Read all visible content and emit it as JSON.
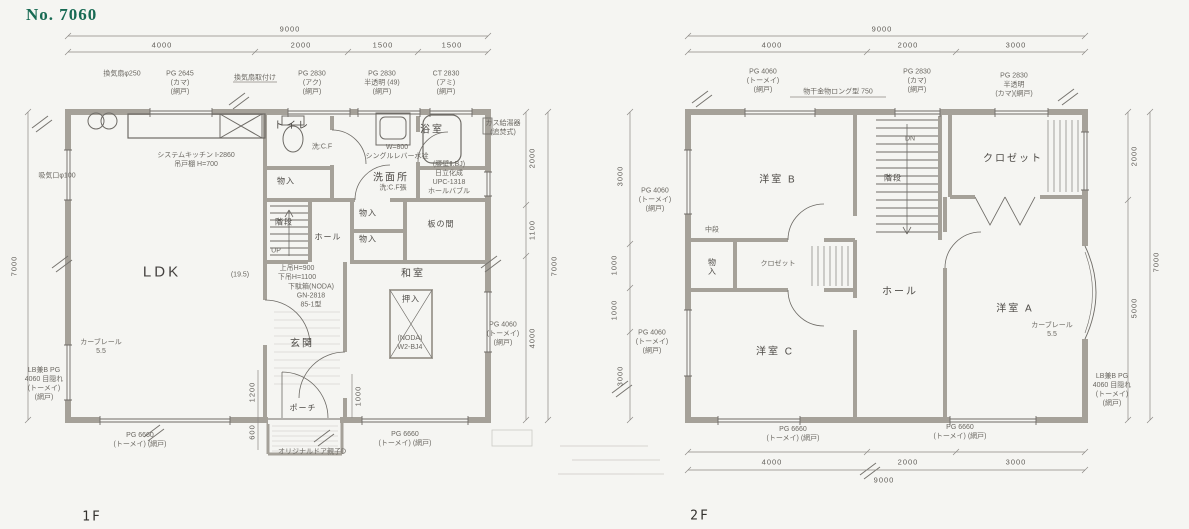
{
  "title": "No. 7060",
  "f1": {
    "floor_label": "1F",
    "rooms": {
      "ldk": "LDK",
      "ldk_size": "(19.5)",
      "toilet": "トイレ",
      "bath": "浴室",
      "washroom": "洗面所",
      "storage_a": "物入",
      "storage_b": "物入",
      "storage_c": "物入",
      "stairs": "階段",
      "up": "UP",
      "hall": "ホール",
      "itanoma": "板の間",
      "washitsu": "和室",
      "oshiire": "押入",
      "genkan": "玄関",
      "porch": "ポーチ"
    },
    "ann": {
      "kitchen1": "システムキッチン I-2860",
      "kitchen2": "吊戸棚 H=700",
      "vent_fan": "換気扇φ250",
      "pg2645_1": "PG 2645",
      "pg2645_2": "(カマ)",
      "pg2645_3": "(網戸)",
      "vent_note": "換気扇取付け",
      "pg2830a_1": "PG 2830",
      "pg2830a_2": "(アク)",
      "pg2830a_3": "(網戸)",
      "pg2830b_1": "PG 2830",
      "pg2830b_2": "半透明 (49)",
      "pg2830b_3": "(網戸)",
      "ct2830_1": "CT 2830",
      "ct2830_2": "(アミ)",
      "ct2830_3": "(網戸)",
      "basin1": "W=800",
      "basin2": "シングルレバー水栓",
      "toilet_floor": "洗:C.F",
      "wash_floor": "洗:C.F張",
      "bath1": "(腰壁Ⅱ.BJ)",
      "bath2": "日立化成",
      "bath3": "UPC-1318",
      "bath4": "ホールバブル",
      "heater1": "ガス給湯器",
      "heater2": "(追焚式)",
      "lintel1": "上吊H=900",
      "lintel2": "下吊H=1100",
      "geta1": "下駄箱(NODA)",
      "geta2": "GN-2818",
      "geta3": "85-1型",
      "oshi1": "(NODA)",
      "oshi2": "W2-BJ4",
      "door": "オリジナルドア親子D",
      "curtain1": "カーブレール",
      "curtain2": "5.5",
      "intake": "吸気口φ100",
      "lb1": "LB兼B PG",
      "lb2": "4060 目隠れ",
      "lb3": "(トーメイ)",
      "lb4": "(網戸)",
      "pg4060r_1": "PG 4060",
      "pg4060r_2": "(トーメイ)",
      "pg4060r_3": "(網戸)",
      "pg6660a_1": "PG 6660",
      "pg6660a_2": "(トーメイ) (網戸)",
      "pg6660b_1": "PG 6660",
      "pg6660b_2": "(トーメイ) (網戸)"
    },
    "dims": {
      "w_total": "9000",
      "w1": "4000",
      "w2": "2000",
      "w3": "1500",
      "w4": "1500",
      "h_total": "7000",
      "r1": "2000",
      "r2": "1100",
      "r3": "4000",
      "r_total": "7000",
      "porch1": "1200",
      "porch2": "600",
      "porch3": "1000"
    }
  },
  "f2": {
    "floor_label": "2F",
    "rooms": {
      "b": "洋室 B",
      "a": "洋室 A",
      "c": "洋室 C",
      "closet": "クロゼット",
      "closet2": "クロゼット",
      "storage": "物入",
      "chudan": "中段",
      "hall": "ホール",
      "stairs": "階段",
      "dn": "DN"
    },
    "ann": {
      "pg4060t_1": "PG 4060",
      "pg4060t_2": "(トーメイ)",
      "pg4060t_3": "(網戸)",
      "monohoshi": "物干金物ロング型 750",
      "pg2830a_1": "PG 2830",
      "pg2830a_2": "(カマ)",
      "pg2830a_3": "(網戸)",
      "pg2830b_1": "PG 2830",
      "pg2830b_2": "半透明",
      "pg2830b_3": "(カマ)(網戸)",
      "pg4060l1_1": "PG 4060",
      "pg4060l1_2": "(トーメイ)",
      "pg4060l1_3": "(網戸)",
      "pg4060l2_1": "PG 4060",
      "pg4060l2_2": "(トーメイ)",
      "pg4060l2_3": "(網戸)",
      "pg6660a_1": "PG 6660",
      "pg6660a_2": "(トーメイ) (網戸)",
      "pg6660b_1": "PG 6660",
      "pg6660b_2": "(トーメイ) (網戸)",
      "curtain1": "カーブレール",
      "curtain2": "5.5",
      "lb1": "LB兼B PG",
      "lb2": "4060 目隠れ",
      "lb3": "(トーメイ)",
      "lb4": "(網戸)"
    },
    "dims": {
      "w_total": "9000",
      "w1": "4000",
      "w2": "2000",
      "w3": "3000",
      "l1": "3000",
      "l2": "1000",
      "l3": "1000",
      "l4": "3000",
      "r1": "2000",
      "r2": "5000",
      "r_total": "7000",
      "b1": "4000",
      "b2": "2000",
      "b3": "3000",
      "b_total": "9000"
    }
  }
}
